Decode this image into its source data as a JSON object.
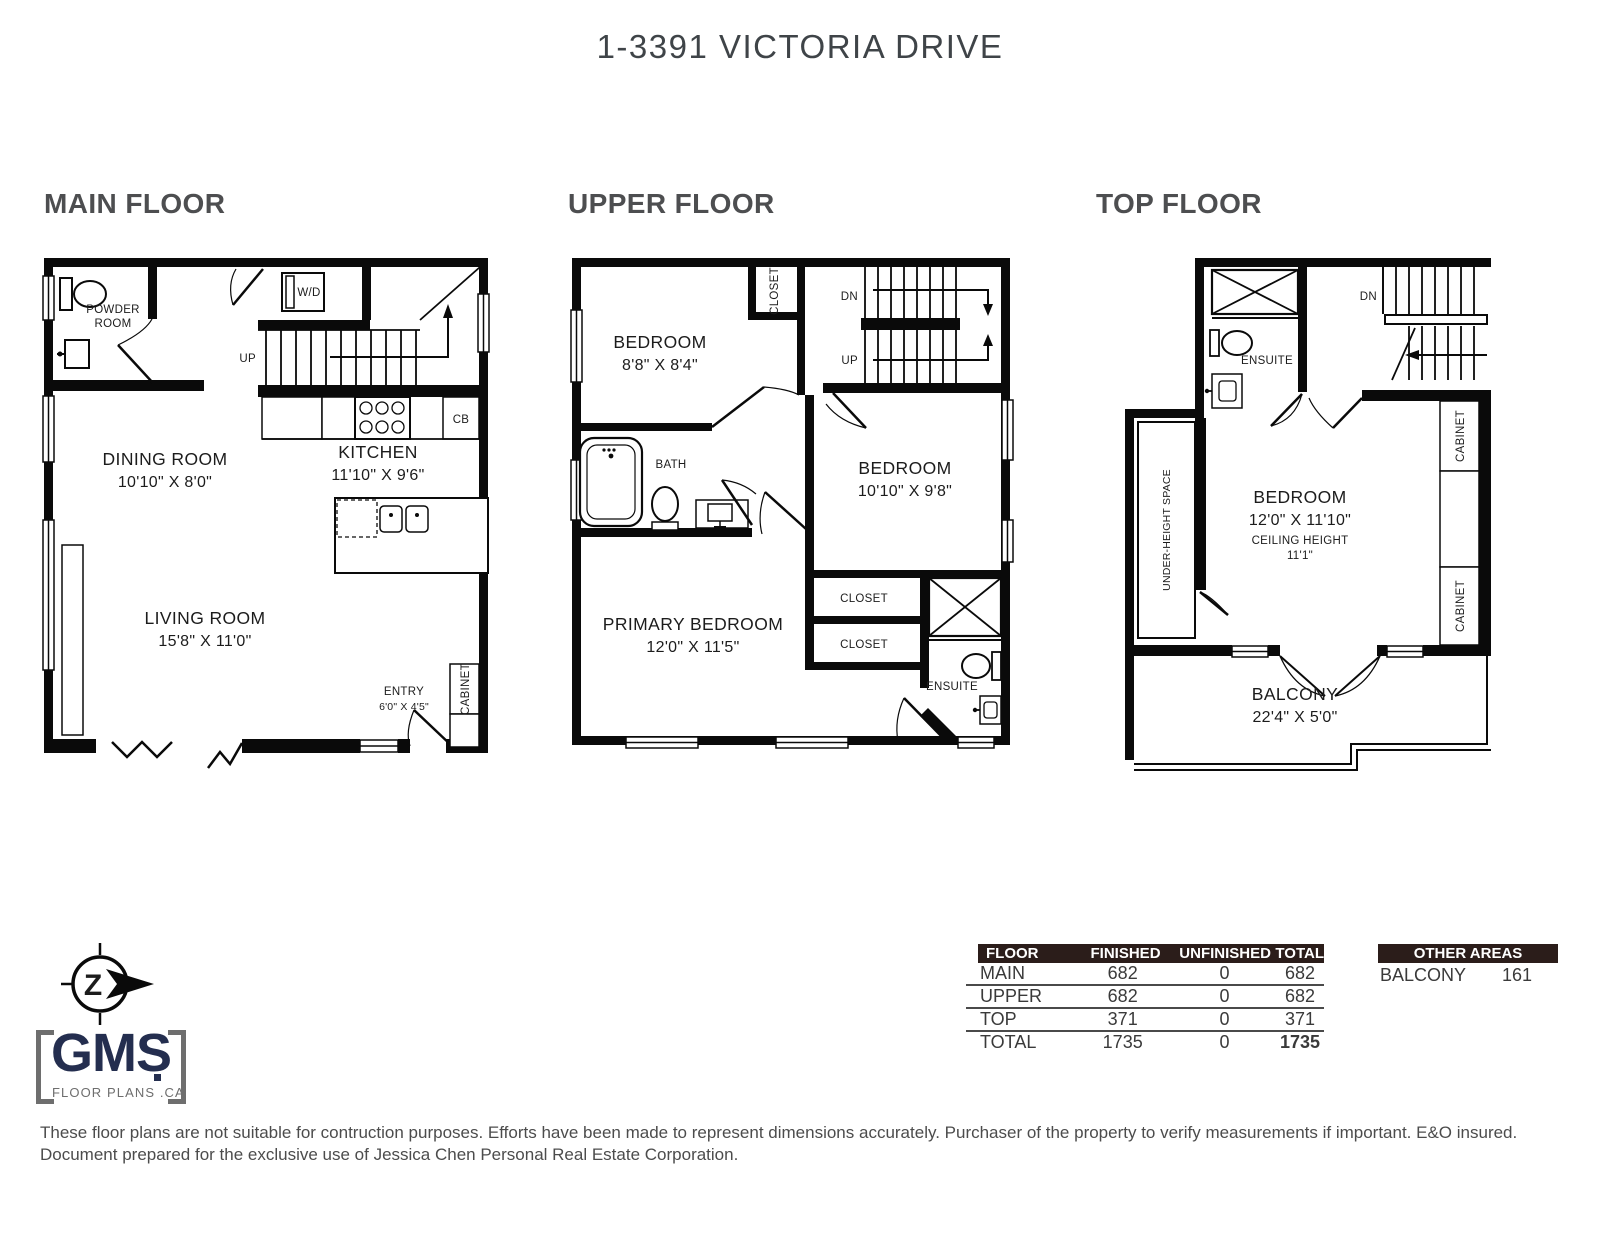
{
  "title": "1-3391 VICTORIA DRIVE",
  "colors": {
    "wall": "#0a0a0a",
    "heading_gray": "#4d4e50",
    "title_gray": "#3f4448",
    "table_header_bg": "#2b1d1a",
    "logo_navy": "#242e4f",
    "logo_gray": "#6e6e6e",
    "disclaimer_text": "#4c4c4c"
  },
  "floors": {
    "main": {
      "heading": "MAIN FLOOR",
      "labels": {
        "powder_line1": "POWDER",
        "powder_line2": "ROOM",
        "wd": "W/D",
        "up": "UP",
        "cb": "CB",
        "dining_name": "DINING ROOM",
        "dining_dims": "10'10\" X 8'0\"",
        "kitchen_name": "KITCHEN",
        "kitchen_dims": "11'10\" X 9'6\"",
        "living_name": "LIVING ROOM",
        "living_dims": "15'8\" X 11'0\"",
        "entry_name": "ENTRY",
        "entry_dims": "6'0\" X 4'5\"",
        "cabinet": "CABINET"
      }
    },
    "upper": {
      "heading": "UPPER FLOOR",
      "labels": {
        "bedroom1_name": "BEDROOM",
        "bedroom1_dims": "8'8\" X 8'4\"",
        "closet_top": "CLOSET",
        "dn": "DN",
        "up": "UP",
        "bath": "BATH",
        "bedroom2_name": "BEDROOM",
        "bedroom2_dims": "10'10\" X 9'8\"",
        "primary_name": "PRIMARY BEDROOM",
        "primary_dims": "12'0\" X 11'5\"",
        "closet1": "CLOSET",
        "closet2": "CLOSET",
        "ensuite": "ENSUITE"
      }
    },
    "top": {
      "heading": "TOP FLOOR",
      "labels": {
        "ensuite": "ENSUITE",
        "dn": "DN",
        "cabinet1": "CABINET",
        "cabinet2": "CABINET",
        "under_height": "UNDER-HEIGHT SPACE",
        "bedroom_name": "BEDROOM",
        "bedroom_dims": "12'0\" X 11'10\"",
        "ceiling_label": "CEILING HEIGHT",
        "ceiling_value": "11'1\"",
        "balcony_name": "BALCONY",
        "balcony_dims": "22'4\" X 5'0\""
      }
    }
  },
  "area_table": {
    "headers": [
      "FLOOR",
      "FINISHED",
      "UNFINISHED",
      "TOTAL"
    ],
    "rows": [
      {
        "floor": "MAIN",
        "finished": "682",
        "unfinished": "0",
        "total": "682"
      },
      {
        "floor": "UPPER",
        "finished": "682",
        "unfinished": "0",
        "total": "682"
      },
      {
        "floor": "TOP",
        "finished": "371",
        "unfinished": "0",
        "total": "371"
      },
      {
        "floor": "TOTAL",
        "finished": "1735",
        "unfinished": "0",
        "total": "1735"
      }
    ]
  },
  "other_areas": {
    "header": "OTHER AREAS",
    "rows": [
      {
        "name": "BALCONY",
        "value": "161"
      }
    ]
  },
  "logo": {
    "compass_letter": "Z",
    "name": "GMS",
    "sub": "FLOOR PLANS .CA"
  },
  "disclaimer": {
    "line1": "These floor plans are not suitable for contruction purposes. Efforts have been made to represent dimensions accurately. Purchaser of the property to verify measurements if important. E&O insured.",
    "line2": "Document prepared for the exclusive use of Jessica Chen Personal Real Estate Corporation."
  }
}
